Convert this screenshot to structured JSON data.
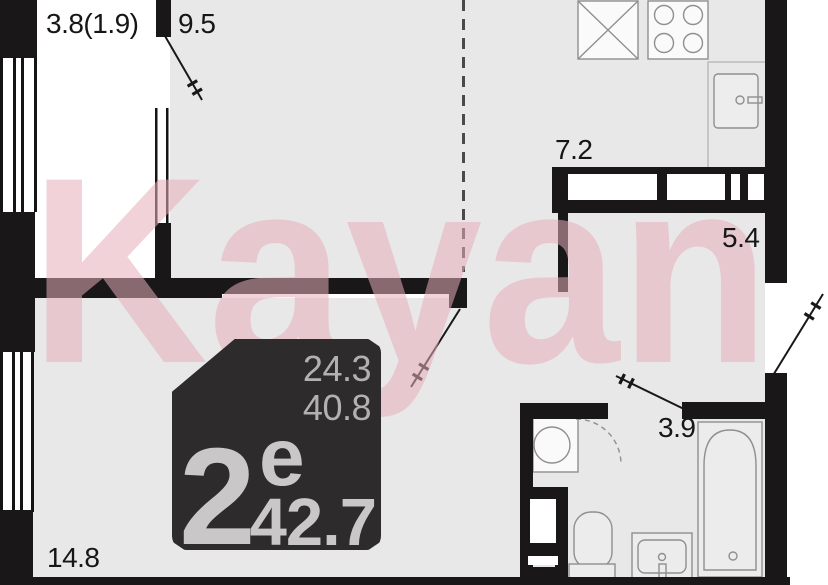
{
  "watermark": {
    "text": "Kayan",
    "color": "#e5adb9"
  },
  "badge": {
    "room_count": "2",
    "class_letter": "е",
    "living_area": "24.3",
    "area_without_balcony": "40.8",
    "total_area": "42.7",
    "background": "#2d2b2c"
  },
  "room_labels": {
    "balcony": "3.8(1.9)",
    "bedroom": "9.5",
    "kitchen": "7.2",
    "hallway": "5.4",
    "bathroom": "3.9",
    "living_room": "14.8"
  },
  "colors": {
    "wall": "#1a1718",
    "floor": "#e8e8e8",
    "watermark_pink": "#e5adb9",
    "badge_text": "#c9c7c8"
  }
}
